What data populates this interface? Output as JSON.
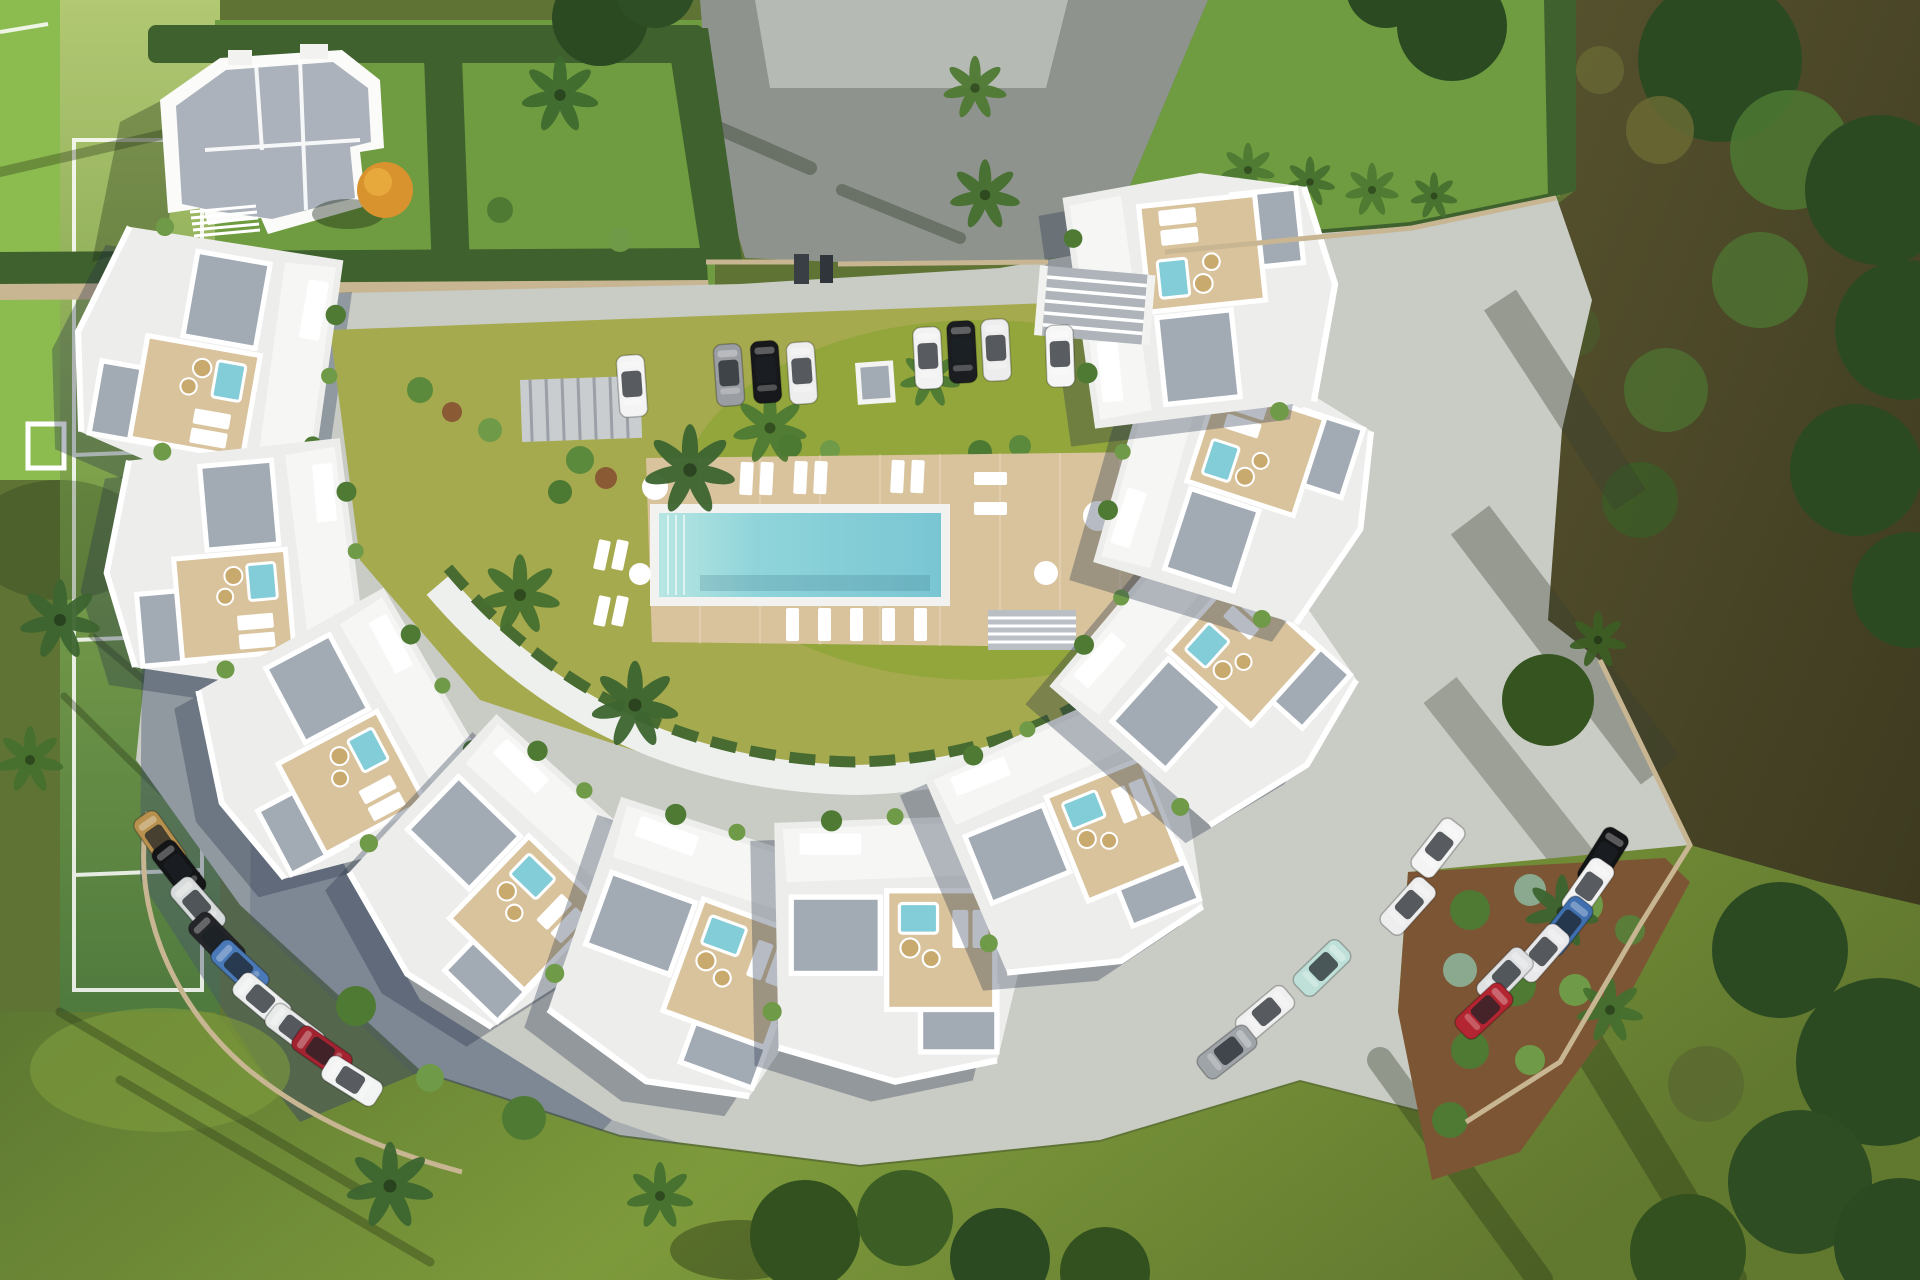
{
  "scene": {
    "description": "Aerial 3D architectural render of a crescent-shaped white residential complex with roof terraces, jacuzzis and wooden decks arranged around a central garden with a rectangular swimming pool; perimeter roads with parked cars, a sports court and detached villa to the north-west, woodland to the east and lawns to the south",
    "areas": [
      "sports-court",
      "villa-plot",
      "driveway",
      "north-parking",
      "crescent-apartments",
      "pool-garden",
      "southwest-parking",
      "southeast-parking",
      "woodland",
      "garden-bed",
      "lawns"
    ]
  },
  "palette": {
    "grass_dark": "#5a7133",
    "grass_mid": "#6f9c40",
    "grass_bright": "#8cbb4f",
    "court_light": "#b2c873",
    "court_mid": "#7fa24c",
    "court_dark": "#4f7a3e",
    "courtyard_lawn": "#a6aa4e",
    "courtyard_bright": "#93a63c",
    "road_light": "#c9cbc5",
    "asphalt": "#8e938e",
    "apron": "#b8bcb6",
    "hedge": "#3f612e",
    "tree_dark": "#2c4a22",
    "tree_mid": "#4e7a33",
    "tree_light": "#6f9a47",
    "building": "#edeeec",
    "terrace": "#f6f7f5",
    "deck": "#d9c39d",
    "gravel": "#a2aab4",
    "pool": "#82cdd8",
    "pool_light": "#b7e6e2",
    "wall_tan": "#c8b592",
    "soil": "#7c5634",
    "wicker": "#c8a96e",
    "lounger": "#ffffff",
    "dark_ground": "#4b472a",
    "autumn_tree": "#d8922e",
    "shadow": "rgba(36,48,72,0.33)"
  },
  "cars": {
    "top_row": [
      "#f4f4f4",
      "#9a9da1",
      "#17181b",
      "#eeeeee",
      "#f2f2f2",
      "#1b1d20",
      "#ededed",
      "#f6f6f6"
    ],
    "southwest_row": [
      "#b8914e",
      "#141517",
      "#d8dbdc",
      "#232528",
      "#4a79b8",
      "#eef0f0",
      "#e8eaea",
      "#a32430",
      "#f2f3f3"
    ],
    "southeast_row": [
      "#131416",
      "#f2f2f2",
      "#3f6fae",
      "#e9e9ec",
      "#dfe1e2",
      "#b32531"
    ],
    "southeast_cluster": [
      "#f4f4f4",
      "#eeeeee",
      "#bfe0d8",
      "#f0f0f0",
      "#9fa4a8"
    ]
  },
  "pool_area": {
    "loungers_top": 6,
    "loungers_bottom": 5,
    "loungers_side": 2,
    "round_tables": 4
  }
}
